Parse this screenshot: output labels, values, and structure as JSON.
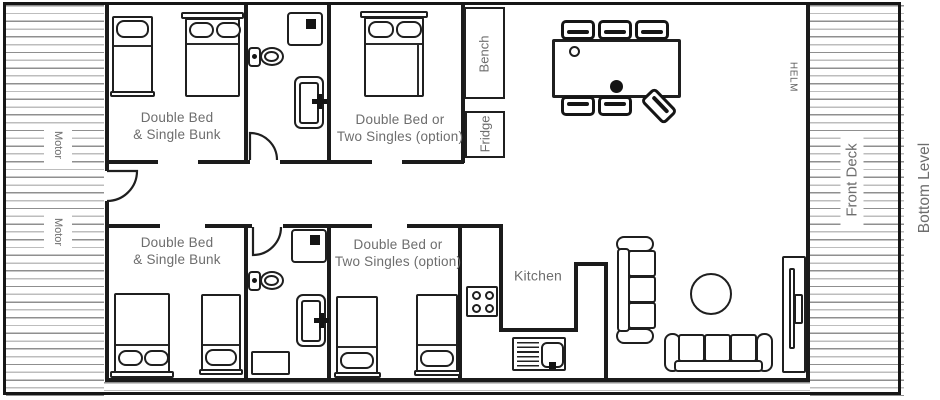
{
  "plan_title": "Bottom Level",
  "areas": {
    "left_deck": {
      "motor_labels": [
        "Motor",
        "Motor"
      ]
    },
    "front_deck": {
      "label": "Front Deck"
    },
    "helm": {
      "label": "HELM"
    },
    "bedrooms": [
      {
        "id": "top-left",
        "label_line1": "Double Bed",
        "label_line2": "& Single Bunk"
      },
      {
        "id": "top-middle",
        "label_line1": "Double Bed or",
        "label_line2": "Two Singles (option)"
      },
      {
        "id": "bottom-left",
        "label_line1": "Double Bed",
        "label_line2": "& Single Bunk"
      },
      {
        "id": "bottom-middle",
        "label_line1": "Double Bed or",
        "label_line2": "Two Singles (option)"
      }
    ],
    "galley": {
      "kitchen_label": "Kitchen",
      "bench_label": "Bench",
      "fridge_label": "Fridge"
    }
  },
  "colors": {
    "wall": "#1b1b1b",
    "label_gray": "#6d6d6d",
    "hatch_line": "#8f8f8f",
    "background": "#ffffff"
  }
}
